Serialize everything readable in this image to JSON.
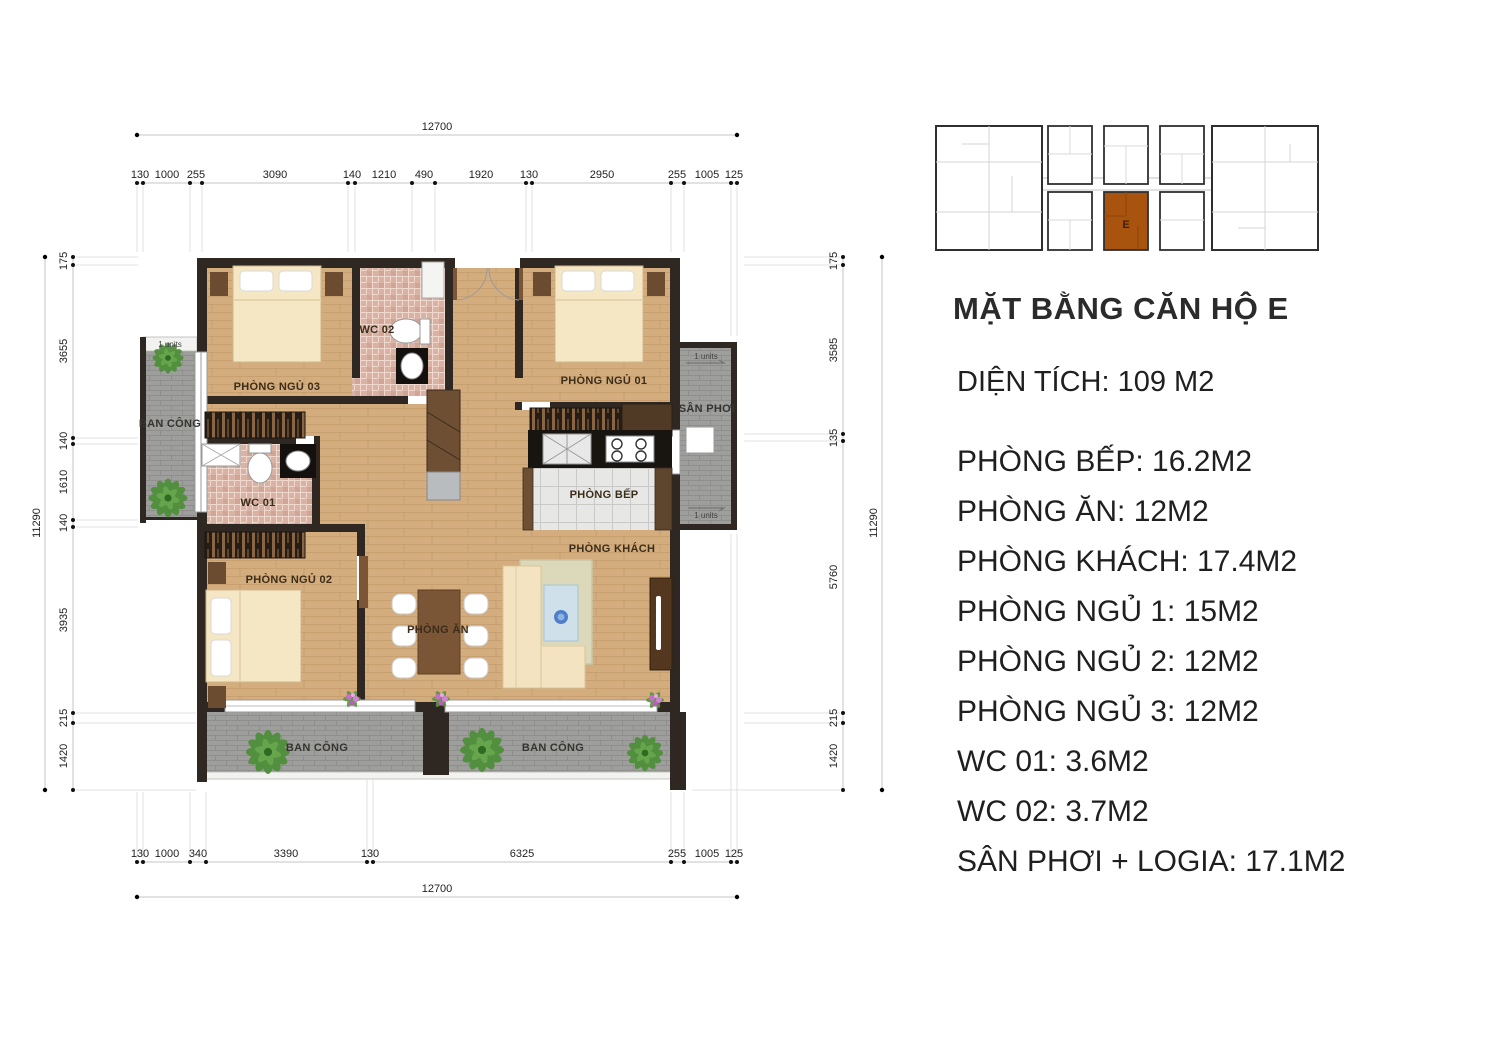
{
  "keyplan": {
    "unit": "E",
    "highlight_color": "#a8540f"
  },
  "panel": {
    "title": "MẶT BẰNG CĂN HỘ E",
    "area": "DIỆN TÍCH: 109 M2",
    "items": [
      "PHÒNG BẾP: 16.2M2",
      "PHÒNG ĂN: 12M2",
      "PHÒNG KHÁCH: 17.4M2",
      "PHÒNG NGỦ 1: 15M2",
      "PHÒNG NGỦ 2: 12M2",
      "PHÒNG NGỦ 3: 12M2",
      "WC 01: 3.6M2",
      "WC 02: 3.7M2",
      "SÂN PHƠI + LOGIA: 17.1M2"
    ]
  },
  "plan": {
    "rooms": {
      "bedroom3": "PHÒNG NGỦ 03",
      "wc02": "WC 02",
      "bedroom1": "PHÒNG NGỦ 01",
      "san_phoi": "SÂN PHƠI",
      "balcony_left": "BAN CÔNG",
      "wc01": "WC 01",
      "kitchen": "PHÒNG BẾP",
      "living": "PHÒNG KHÁCH",
      "bedroom2": "PHÒNG NGỦ 02",
      "dining": "PHÒNG ĂN",
      "balcony_bottom_left": "BAN CÔNG",
      "balcony_bottom_right": "BAN CÔNG",
      "units_left": "1 units",
      "units_top": "1 units",
      "units_bottom": "1 units"
    },
    "dims": {
      "top": {
        "overall": "12700",
        "segments": [
          "130",
          "1000",
          "255",
          "3090",
          "140",
          "1210",
          "490",
          "1920",
          "130",
          "2950",
          "255",
          "1005",
          "125"
        ]
      },
      "bottom": {
        "overall": "12700",
        "segments": [
          "130",
          "1000",
          "340",
          "3390",
          "130",
          "6325",
          "255",
          "1005",
          "125"
        ]
      },
      "left": {
        "overall": "11290",
        "segments": [
          "175",
          "3655",
          "140",
          "1610",
          "140",
          "3935",
          "215",
          "1420"
        ]
      },
      "right": {
        "overall": "11290",
        "segments": [
          "175",
          "3585",
          "135",
          "5760",
          "215",
          "1420"
        ]
      }
    }
  },
  "colors": {
    "wall": "#2f2822",
    "floor": "#d4ad7e",
    "balcony": "#9e9e9c",
    "highlight": "#a8540f"
  }
}
